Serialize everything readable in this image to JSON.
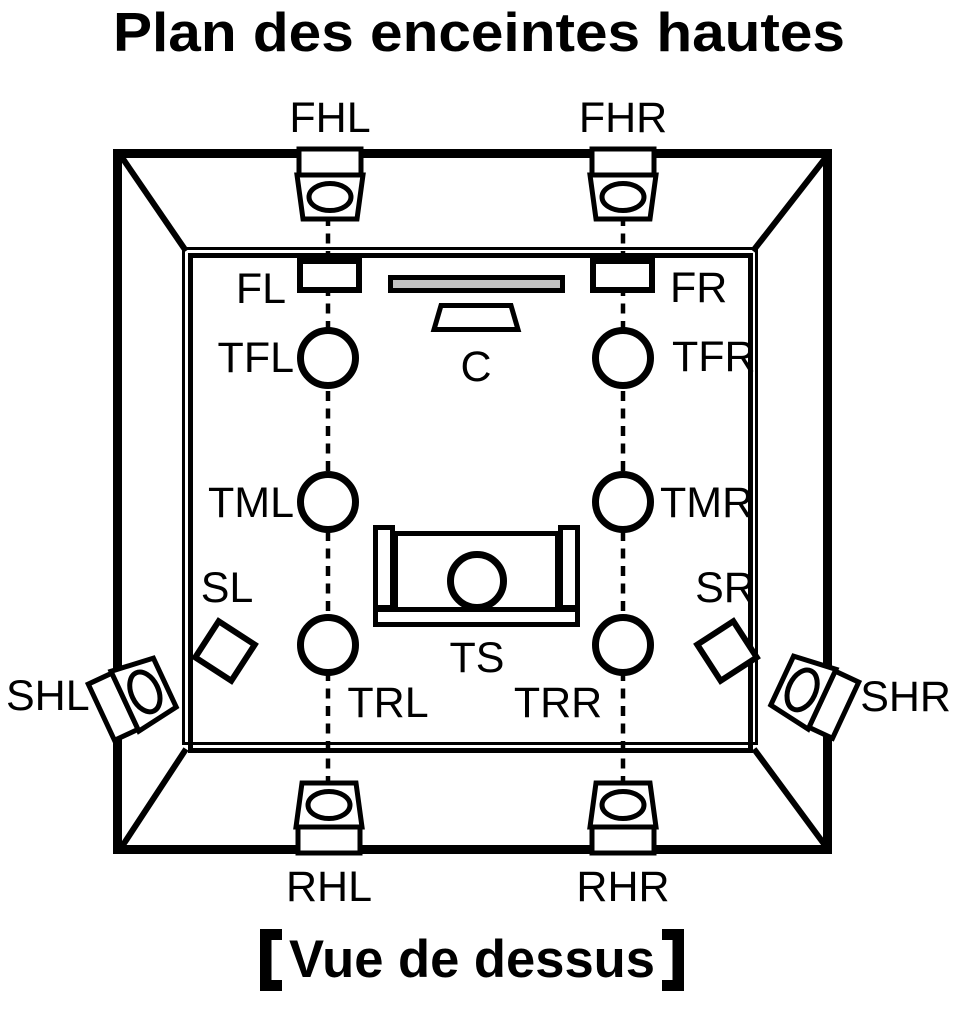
{
  "title": "Plan des enceintes hautes",
  "caption": {
    "full": "【Vue de dessus】",
    "text": "Vue de dessus"
  },
  "colors": {
    "line": "#000000",
    "background": "#ffffff",
    "tv_fill": "#c2c2c2"
  },
  "speakers": {
    "front_height_left": "FHL",
    "front_height_right": "FHR",
    "front_left": "FL",
    "front_right": "FR",
    "center": "C",
    "top_front_left": "TFL",
    "top_front_right": "TFR",
    "top_middle_left": "TML",
    "top_middle_right": "TMR",
    "surround_left": "SL",
    "surround_right": "SR",
    "surround_height_left": "SHL",
    "surround_height_right": "SHR",
    "top_rear_left": "TRL",
    "top_rear_right": "TRR",
    "top_surround": "TS",
    "rear_height_left": "RHL",
    "rear_height_right": "RHR"
  }
}
